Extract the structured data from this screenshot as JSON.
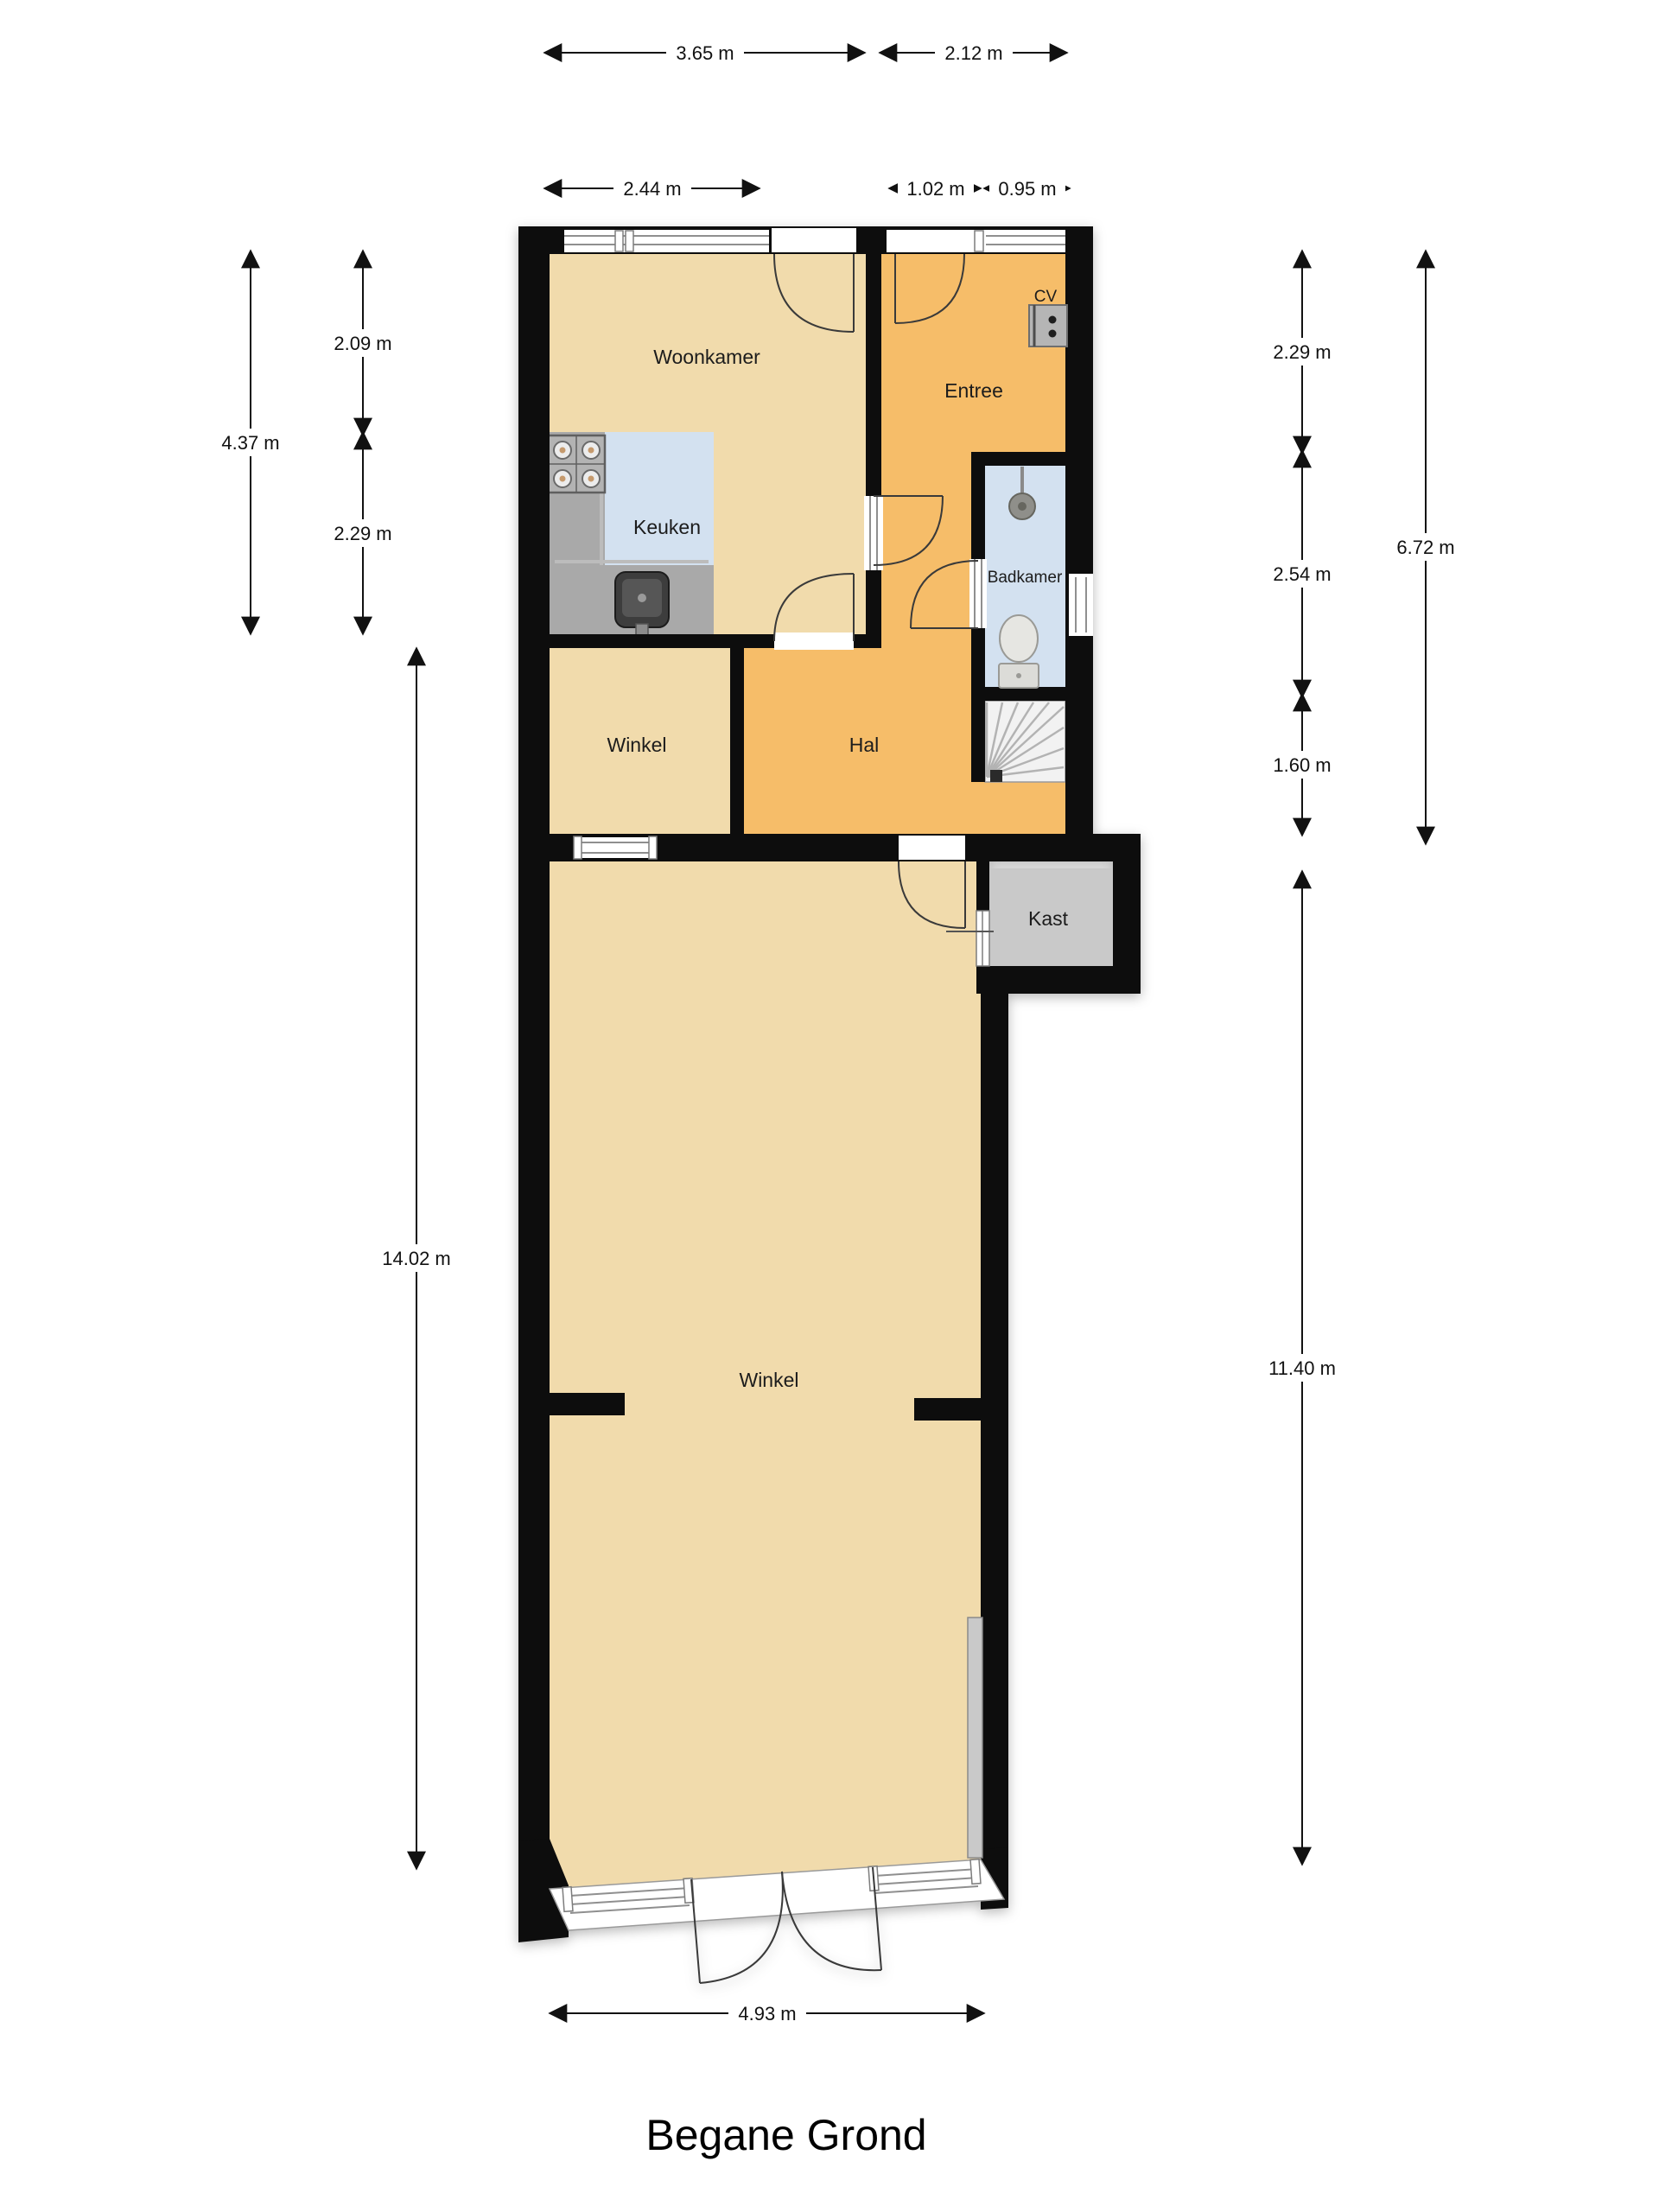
{
  "title": "Begane Grond",
  "rooms": {
    "woonkamer": "Woonkamer",
    "entree": "Entree",
    "keuken": "Keuken",
    "badkamer": "Badkamer",
    "winkel_klein": "Winkel",
    "hal": "Hal",
    "kast": "Kast",
    "winkel_groot": "Winkel",
    "cv": "CV"
  },
  "dimensions": {
    "top_woonkamer": "3.65 m",
    "top_entree": "2.12 m",
    "top_woonkamer_window": "2.44 m",
    "top_entree_door": "1.02 m",
    "top_entree_window": "0.95 m",
    "left_woonkamer": "2.09 m",
    "left_upper_totaal": "4.37 m",
    "left_keuken": "2.29 m",
    "left_winkel": "14.02 m",
    "right_entree": "2.29 m",
    "right_upper_totaal": "6.72 m",
    "right_badkamer": "2.54 m",
    "right_trap": "1.60 m",
    "right_winkel": "11.40 m",
    "bottom_winkel": "4.93 m"
  },
  "colors": {
    "floor_tan": "#f1dbac",
    "floor_orange": "#f6bd69",
    "floor_blue": "#d3e1f0",
    "wall": "#0d0d0d",
    "counter": "#a9a9a9",
    "counter_light": "#bcbcbc",
    "kast_gray": "#c9c9c9",
    "stairs_bg": "#f2f2f2"
  }
}
